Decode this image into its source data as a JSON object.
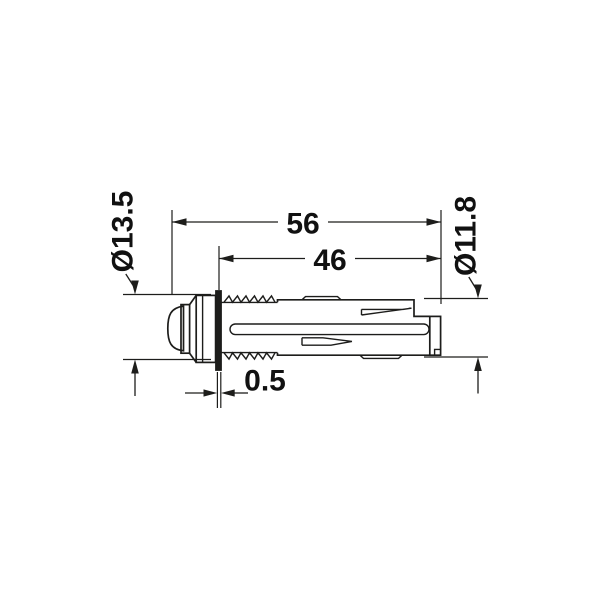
{
  "page": {
    "background": "#ffffff",
    "line_color": "#1d1d1b",
    "text_color": "#111111"
  },
  "drawing": {
    "dimensions": {
      "length_overall": "56",
      "length_body": "46",
      "dia_front": "Ø13.5",
      "dia_body": "Ø11.8",
      "flange_thickness": "0.5"
    }
  }
}
